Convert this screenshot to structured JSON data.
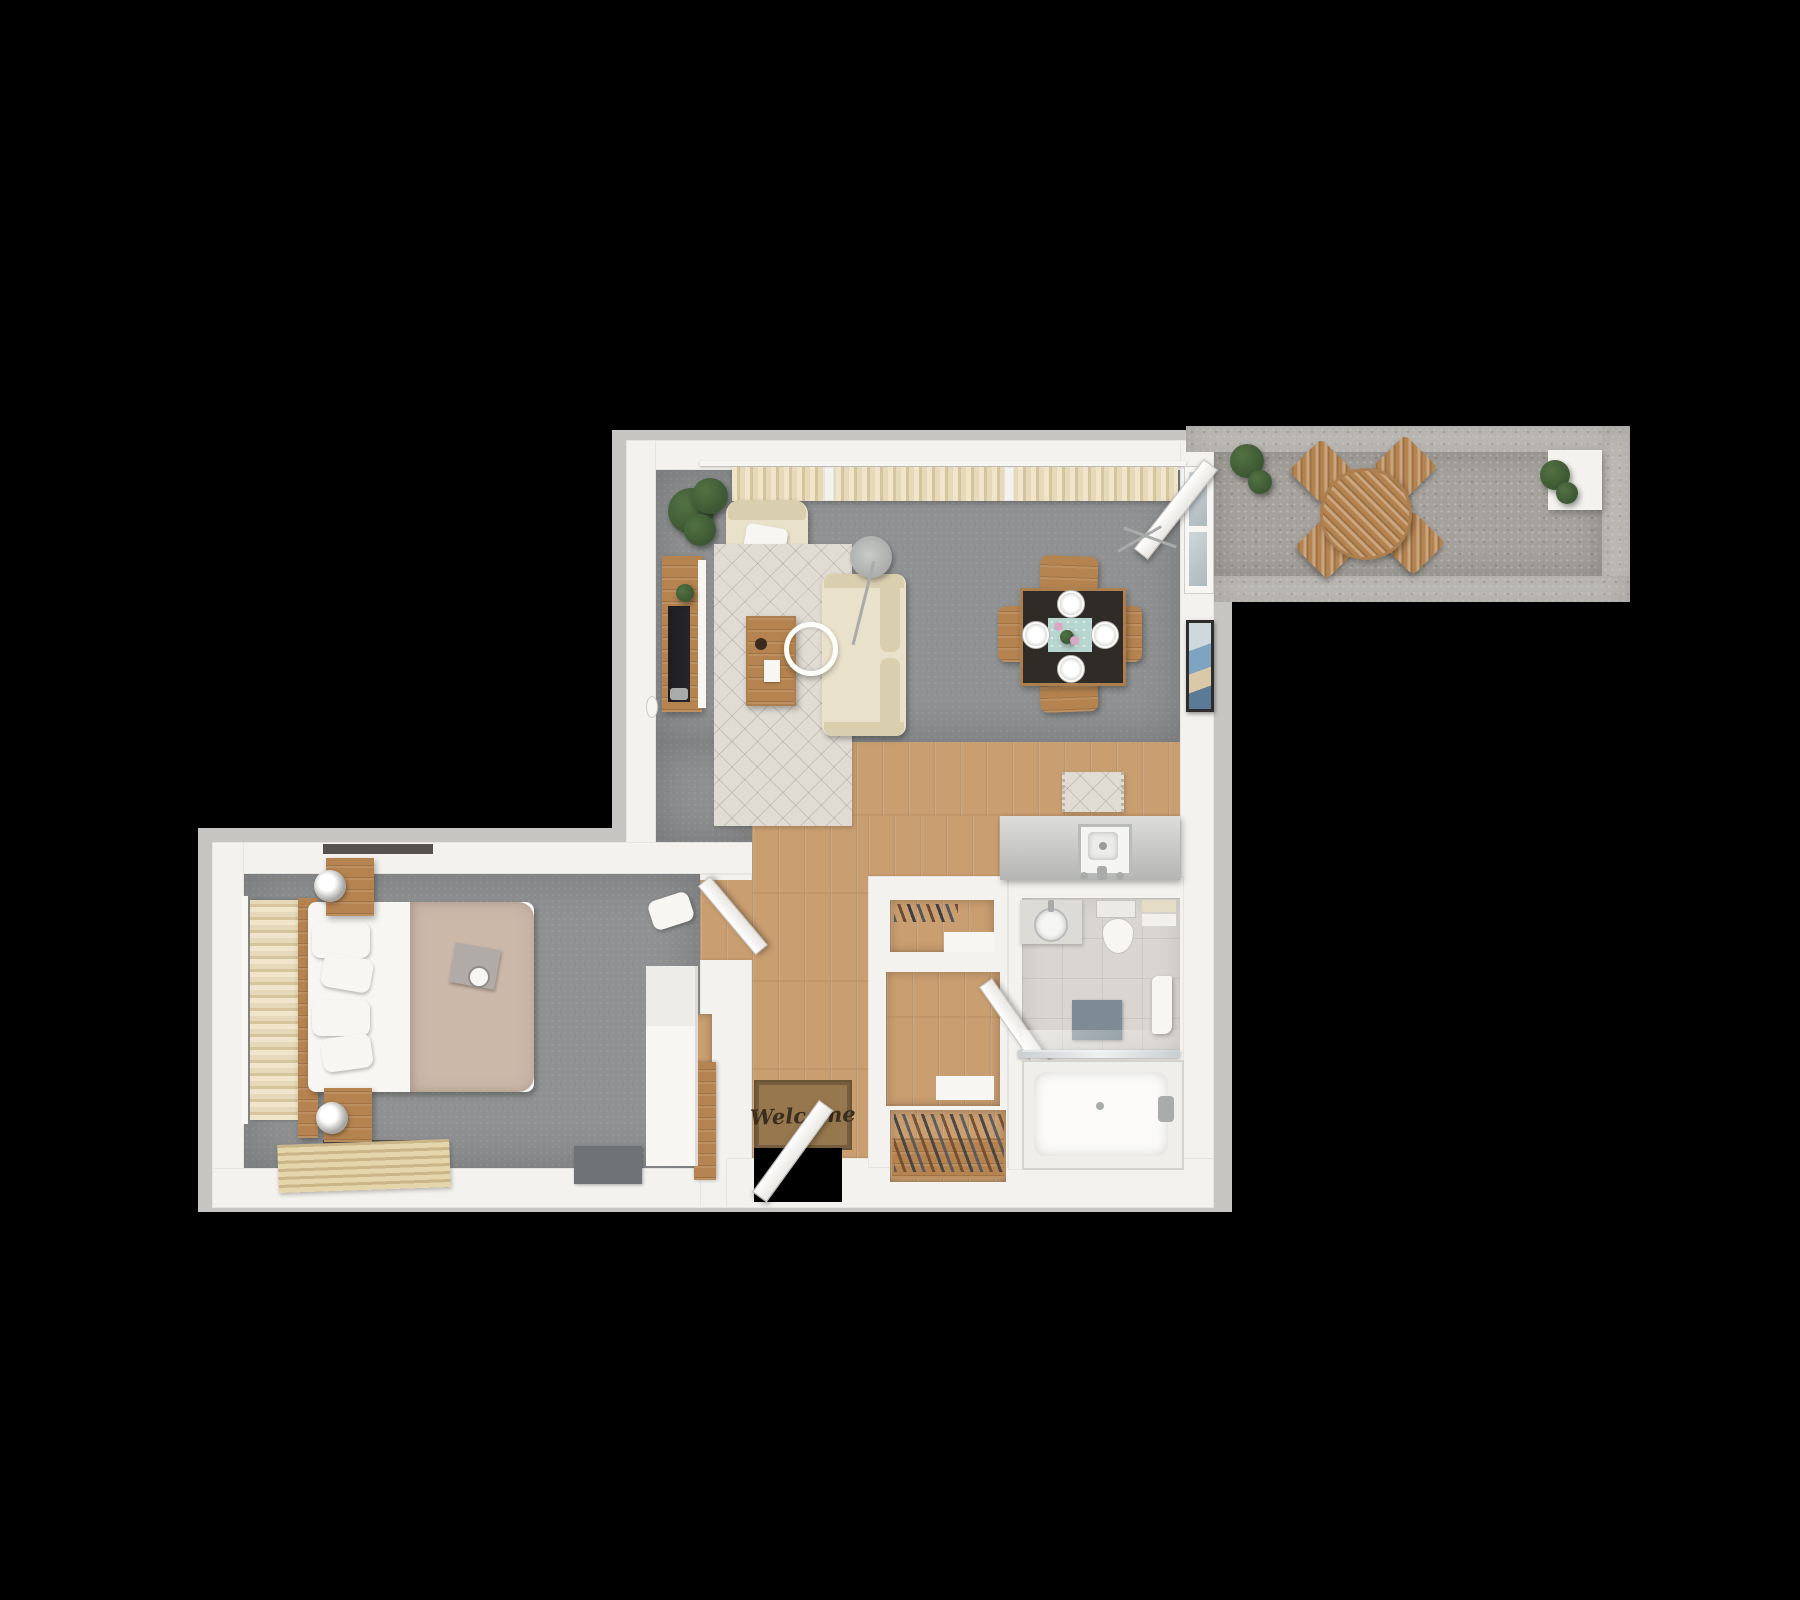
{
  "scene": {
    "description": "3D top-down floor plan rendering of a one-bedroom apartment with balcony on a black background",
    "view": "top-down dollhouse",
    "background": "#000000"
  },
  "labels": {
    "welcome_mat": "Welcome"
  },
  "palette": {
    "bg": "#000000",
    "wall": "#f4f2ee",
    "wall_edge": "#dbd9d5",
    "rim": "#c7c5c1",
    "carpet": "#8f9192",
    "wood": "#c99e70",
    "wood_dark": "#ad7f4e",
    "wood_chair": "#b5834f",
    "concrete": "#a5a29d",
    "tile": "#d9d6d1",
    "cream": "#e9e1ca",
    "cream_dark": "#d9cfae",
    "rug": "#e0dcd3",
    "curtain": "#e6d9ba",
    "curtain_dark": "#d6c49c",
    "plant": "#3c5733",
    "table_dark": "#2f2b27",
    "teal": "#b7d6cf",
    "duvet": "#ccb8a9",
    "white": "#f7f6f3",
    "mat_brown": "#97774e",
    "mat_text": "#3a2e1f",
    "slate": "#7e8b94",
    "glass": "#aeb9bd",
    "metal": "#a9abaa",
    "tv": "#26262a"
  },
  "rooms": [
    {
      "id": "living-room",
      "floor": "gray carpet",
      "items": [
        "window-curtains",
        "corner-plant",
        "armchair",
        "throw-pillow",
        "tv-console",
        "tv",
        "console-plant",
        "area-rug",
        "coffee-table",
        "pendant-ring-light",
        "sofa",
        "arc-floor-lamp",
        "wall-sconce",
        "drying-rack",
        "wall-art",
        "balcony-glass-door"
      ]
    },
    {
      "id": "dining-area",
      "floor": "gray carpet",
      "items": [
        "dining-table",
        "dining-chairs-x4",
        "place-settings-x4",
        "table-runner",
        "flower-centerpiece"
      ]
    },
    {
      "id": "kitchen",
      "floor": "wood plank",
      "items": [
        "island-counter",
        "square-sink",
        "faucet",
        "kitchen-mat"
      ]
    },
    {
      "id": "hallway-entry",
      "floor": "wood plank",
      "items": [
        "front-door",
        "welcome-mat",
        "shoe-rack",
        "closet-nooks",
        "bathroom-door",
        "wood-cabinet"
      ]
    },
    {
      "id": "bedroom",
      "floor": "gray carpet",
      "items": [
        "window-curtain",
        "headboard",
        "double-bed",
        "duvet",
        "pillows-x4",
        "breakfast-tray",
        "nightstand-x2",
        "table-lamp-x2",
        "wall-shelves",
        "slat-rug",
        "doormat",
        "wardrobe-desk",
        "side-chair",
        "bedroom-door"
      ]
    },
    {
      "id": "bathroom",
      "floor": "tile",
      "items": [
        "vanity-sink",
        "toilet",
        "towel-stack",
        "bath-mat",
        "hanging-towel",
        "glass-screen",
        "bathtub",
        "tub-faucet"
      ]
    },
    {
      "id": "balcony",
      "floor": "concrete",
      "items": [
        "round-bistro-table",
        "bistro-chairs-x4",
        "potted-plant-x2"
      ]
    }
  ]
}
